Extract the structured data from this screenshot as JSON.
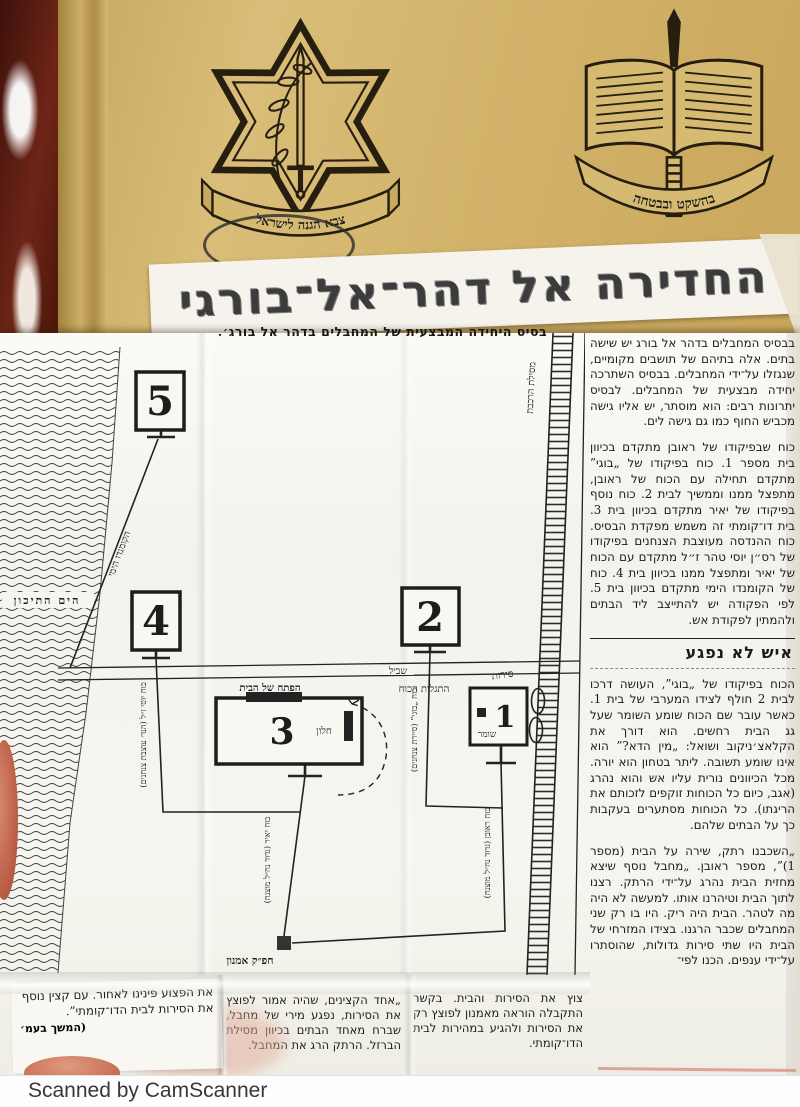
{
  "palette": {
    "parchment": "#d5b56c",
    "paper": "#f6f5f0",
    "ink": "#1c1c1c",
    "leather": "#4a160f"
  },
  "cover": {
    "idf_banner": "צבא הגנה לישראל",
    "mod_banner": "בהשקט ובבטחה"
  },
  "headline": "החדירה אל דהר־אל־בורגי",
  "map": {
    "caption": "בסיס היחידה המבצעית של המחבלים בדהר אל בורג׳.",
    "sea": "הים התיכון",
    "railway": "מסילת הרכבת",
    "trail": "שביל",
    "boats": "סירות",
    "discovery": "התגלות הכוח",
    "house3_entrance": "הפתח של הבית",
    "house3_window": "חלון",
    "house1_guard": "שומר",
    "command_post": "חפ״ק אמנון",
    "boxes": {
      "b1": "1",
      "b2": "2",
      "b3": "3",
      "b4": "4",
      "b5": "5"
    },
    "routes": {
      "naval": "הקומנדו הימי",
      "yossi": "כוח יוסי ז״ל (הנד׳ עוצבת צנחנים)",
      "yair": "כוח יאיר (גדוד נח״ל מוצנח)",
      "bogie": "כוח „בוגי” (סיירת צנחנים)",
      "reuven": "כוח ראובן (גדוד נח״ל מוצנח)"
    }
  },
  "article": {
    "p1": "בבסיס המחבלים בדהר אל בורג יש שישה בתים. אלה בתיהם של תושבים מקומיים, שנגזלו על־ידי המחבלים. בבסיס השתרכה יחידה מבצעית של המחבלים. לבסיס יתרונות רבים: הוא מוסתר, יש אליו גישה מכביש החוף כמו גם גישה לים.",
    "p2": "כוח שבפיקודו של ראובן מתקדם בכיוון בית מספר 1. כוח בפיקודו של „בוגי” מתקדם תחילה עם הכוח של ראובן, מתפצל ממנו וממשיך לבית 2. כוח נוסף בפיקודו של יאיר מתקדם בכיוון בית 3. בית דו־קומתי זה משמש מפקדת הבסיס. כוח ההנדסה מעוצבת הצנחנים בפיקודו של רס״ן יוסי טהר ז״ל מתקדם עם הכוח של יאיר ומתפצל ממנו בכיוון בית 4. כוח של הקומנדו הימי מתקדם בכיוון בית 5. לפי הפקודה יש להתייצב ליד הבתים ולהמתין לפקודת אש.",
    "heading": "איש לא נפגע",
    "p3": "הכוח בפיקודו של „בוגי”, העושה דרכו לבית 2 חולף לצידו המערבי של בית 1. כאשר עובר שם הכוח שומע השומר שעל גג הבית רחשים. הוא דורך את הקלאצ׳ניקוב ושואל: „מין הדא?” הוא אינו שומע תשובה. ליתר בטחון הוא יורה. מכל הכיוונים נורית עליו אש והוא נהרג (אגב, כיום כל הכוחות זוקפים לזכותם את הריגתו). כל הכוחות מסתערים בעקבות כך על הבתים שלהם.",
    "p4": "„השכבנו רתק, שירה על הבית (מספר 1)”, מספר ראובן. „מחבל נוסף שיצא מחזית הבית נהרג על־ידי הרתק. רצנו לתוך הבית וטיהרנו אותו. למעשה לא היה מה לטהר. הבית היה ריק. היו בו רק שני המחבלים שכבר הרגנו. בצידו המזרחי של הבית היו שתי סירות גדולות, שהוסתרו על־ידי ענפים. הכנו לפי־",
    "bottom_right": "צוץ את הסירות והבית. בקשר התקבלה הוראה מאמנון לפוצץ רק את הסירות ולהגיע במהירות לבית הדו־קומתי.",
    "bottom_mid": "„אחד הקצינים, שהיה אמור לפוצץ את הסירות, נפגע מירי של מחבל, שברח מאחד הבתים בכיוון מסילת הברזל. הרתק הרג את המחבל.",
    "bottom_left": "את הפצוע פינינו לאחור. עם קצין נוסף את הסירות לבית הדו־קומתי”.",
    "continuation": "(המשך בעמ׳"
  },
  "scan_bar": {
    "label": "Scanned by CamScanner"
  }
}
